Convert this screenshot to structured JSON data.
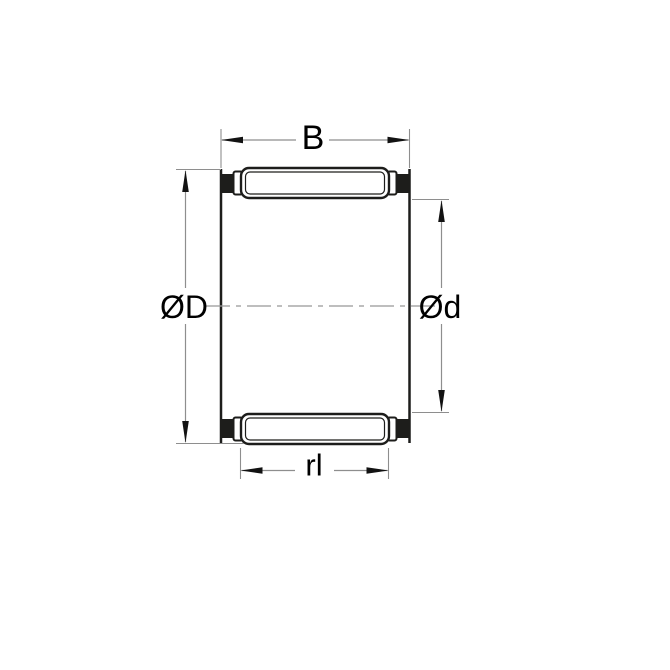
{
  "colors": {
    "background": "#ffffff",
    "drawing_line": "#1d1d1b",
    "solid_fill": "#1d1d1b",
    "dimension_line": "#8e8e8e",
    "centerline": "#989898",
    "arrow": "#121212",
    "label_text": "#000000"
  },
  "dimension_labels": {
    "width": "B",
    "outer_diameter": "ØD",
    "inner_diameter": "Ød",
    "roller_length": "rl"
  }
}
